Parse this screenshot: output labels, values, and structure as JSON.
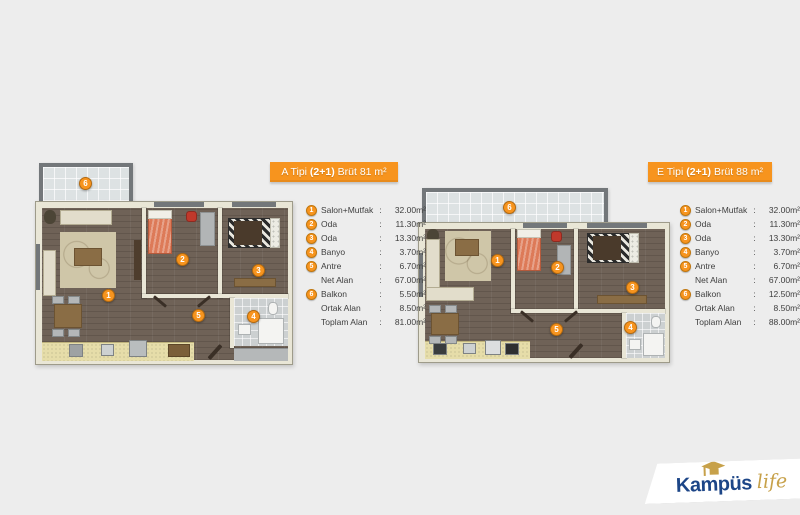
{
  "colors": {
    "accent_orange": "#f7941e",
    "background": "#ededed",
    "logo_navy": "#1c4587",
    "logo_gold": "#c7a14a"
  },
  "plan_a": {
    "title_prefix": "A Tipi ",
    "title_bold": "(2+1)",
    "title_suffix": " Brüt 81 m²",
    "markers": [
      "1",
      "2",
      "3",
      "4",
      "5",
      "6"
    ],
    "legend": [
      {
        "num": "1",
        "label": "Salon+Mutfak",
        "sep": ":",
        "value": "32.00m²"
      },
      {
        "num": "2",
        "label": "Oda",
        "sep": ":",
        "value": "11.30m²"
      },
      {
        "num": "3",
        "label": "Oda",
        "sep": ":",
        "value": "13.30m²"
      },
      {
        "num": "4",
        "label": "Banyo",
        "sep": ":",
        "value": "3.70m²"
      },
      {
        "num": "5",
        "label": "Antre",
        "sep": ":",
        "value": "6.70m²"
      },
      {
        "num": "",
        "label": "Net Alan",
        "sep": ":",
        "value": "67.00m²"
      },
      {
        "num": "6",
        "label": "Balkon",
        "sep": ":",
        "value": "5.50m²"
      },
      {
        "num": "",
        "label": "Ortak Alan",
        "sep": ":",
        "value": "8.50m²"
      },
      {
        "num": "",
        "label": "Toplam Alan",
        "sep": ":",
        "value": "81.00m²"
      }
    ]
  },
  "plan_e": {
    "title_prefix": "E Tipi ",
    "title_bold": "(2+1)",
    "title_suffix": " Brüt 88 m²",
    "markers": [
      "1",
      "2",
      "3",
      "4",
      "5",
      "6"
    ],
    "legend": [
      {
        "num": "1",
        "label": "Salon+Mutfak",
        "sep": ":",
        "value": "32.00m²"
      },
      {
        "num": "2",
        "label": "Oda",
        "sep": ":",
        "value": "11.30m²"
      },
      {
        "num": "3",
        "label": "Oda",
        "sep": ":",
        "value": "13.30m²"
      },
      {
        "num": "4",
        "label": "Banyo",
        "sep": ":",
        "value": "3.70m²"
      },
      {
        "num": "5",
        "label": "Antre",
        "sep": ":",
        "value": "6.70m²"
      },
      {
        "num": "",
        "label": "Net Alan",
        "sep": ":",
        "value": "67.00m²"
      },
      {
        "num": "6",
        "label": "Balkon",
        "sep": ":",
        "value": "12.50m²"
      },
      {
        "num": "",
        "label": "Ortak Alan",
        "sep": ":",
        "value": "8.50m²"
      },
      {
        "num": "",
        "label": "Toplam Alan",
        "sep": ":",
        "value": "88.00m²"
      }
    ]
  },
  "logo": {
    "brand": "Kampüs",
    "word": "life"
  }
}
